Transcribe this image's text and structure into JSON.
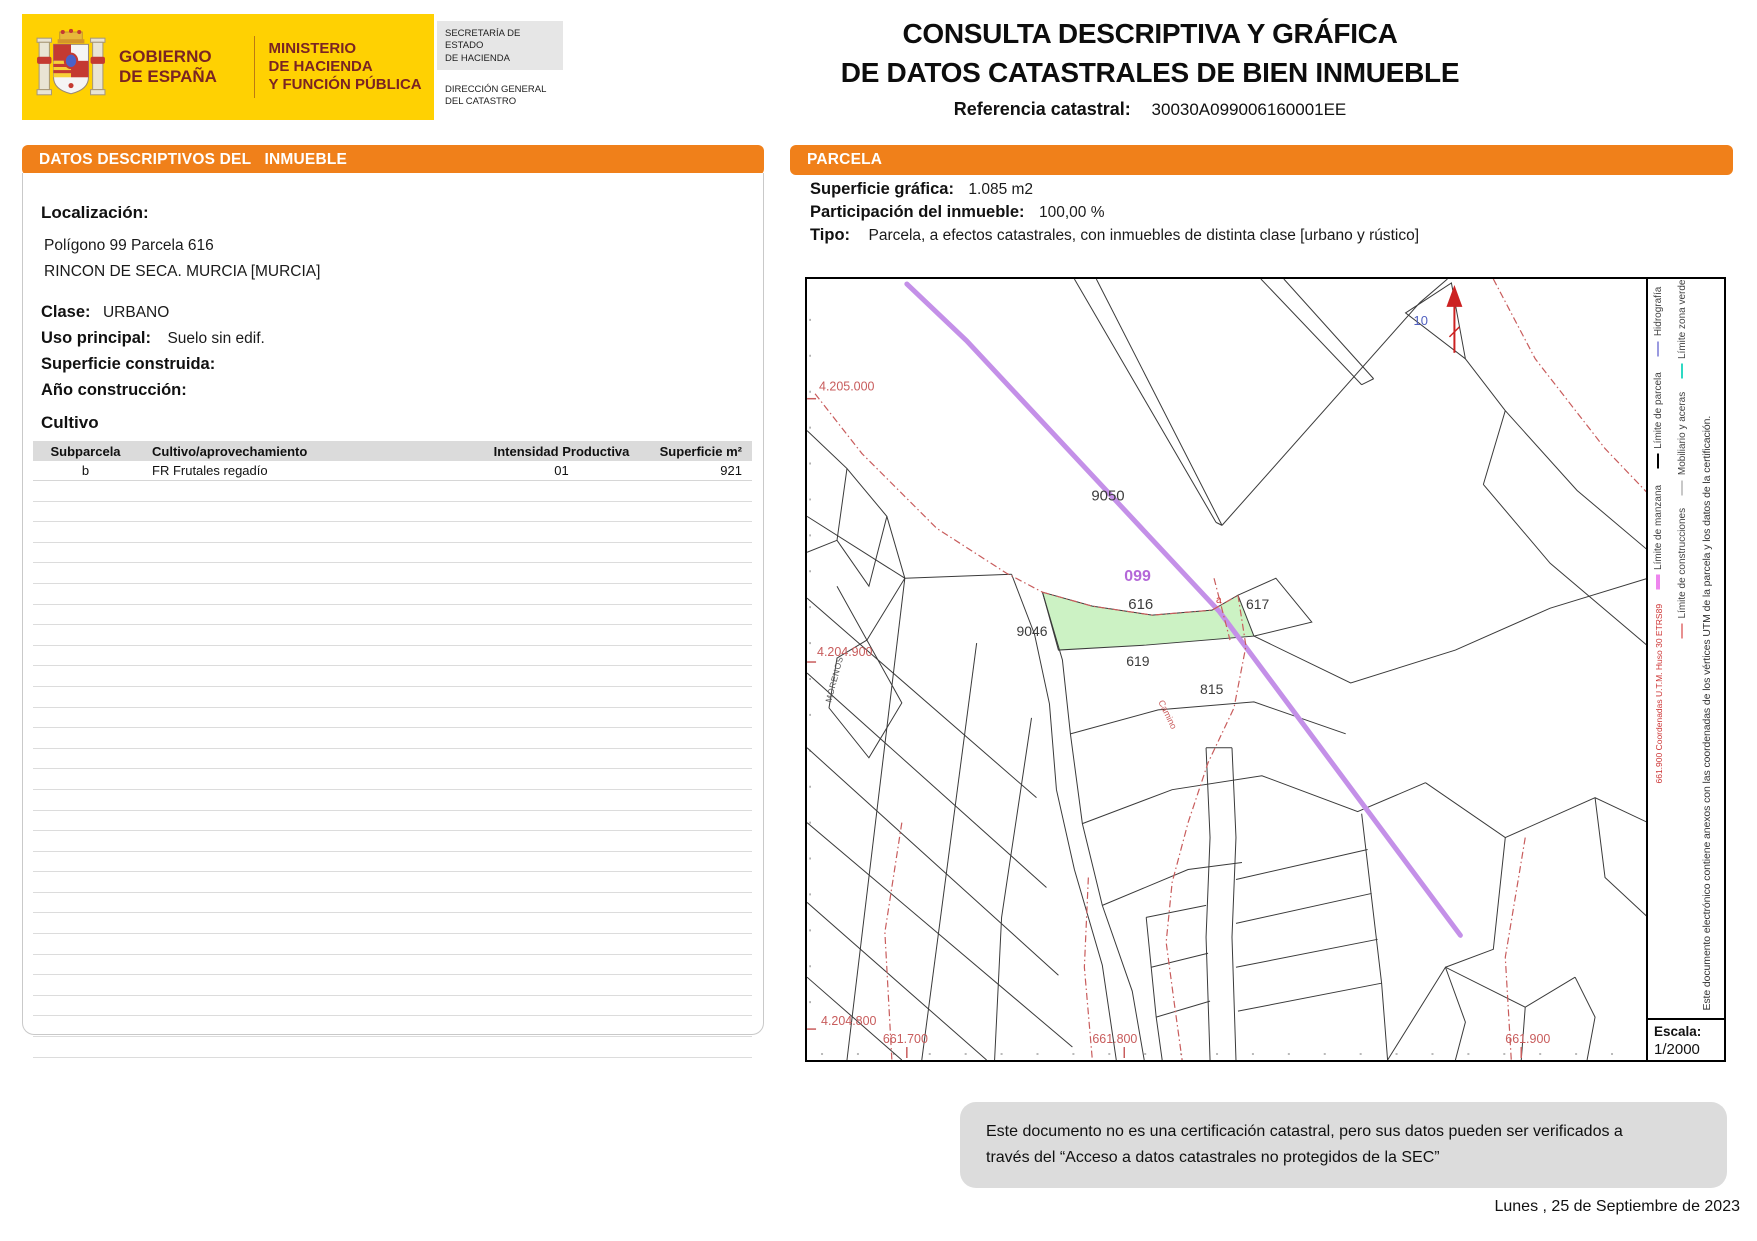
{
  "header": {
    "logo": {
      "gobierno_line1": "GOBIERNO",
      "gobierno_line2": "DE ESPAÑA",
      "ministerio_line1": "MINISTERIO",
      "ministerio_line2": "DE HACIENDA",
      "ministerio_line3": "Y FUNCIÓN PÚBLICA"
    },
    "secretaria_line1": "SECRETARÍA DE ESTADO",
    "secretaria_line2": "DE HACIENDA",
    "direccion_line1": "DIRECCIÓN GENERAL",
    "direccion_line2": "DEL CATASTRO",
    "title_line1": "CONSULTA DESCRIPTIVA Y GRÁFICA",
    "title_line2": "DE DATOS CATASTRALES DE BIEN INMUEBLE",
    "referencia_label": "Referencia catastral:",
    "referencia_value": "30030A099006160001EE"
  },
  "colors": {
    "accent_orange": "#F0801A",
    "gov_yellow": "#FFD102",
    "gov_maroon": "#7A2423",
    "parcel_green": "#CCF2C4",
    "hydro_purple": "#C490E8",
    "red_boundary": "#C85C5C"
  },
  "left_panel": {
    "title_prefix": "DATOS DESCRIPTIVOS DEL",
    "title_bold": "INMUEBLE",
    "localizacion_label": "Localización:",
    "localizacion_line1": "Polígono 99 Parcela 616",
    "localizacion_line2": "RINCON DE SECA. MURCIA [MURCIA]",
    "clase_label": "Clase:",
    "clase_value": "URBANO",
    "uso_label": "Uso principal:",
    "uso_value": "Suelo sin edif.",
    "superficie_label": "Superficie construida:",
    "ano_label": "Año construcción:",
    "cultivo_heading": "Cultivo",
    "table": {
      "headers": [
        "Subparcela",
        "Cultivo/aprovechamiento",
        "Intensidad Productiva",
        "Superficie m²"
      ],
      "rows": [
        {
          "subparcela": "b",
          "cultivo": "FR Frutales regadío",
          "intensidad": "01",
          "superficie": "921"
        }
      ]
    }
  },
  "right_panel": {
    "title": "PARCELA",
    "superficie_label": "Superficie gráfica:",
    "superficie_value": "1.085 m2",
    "participacion_label": "Participación del inmueble:",
    "participacion_value": "100,00 %",
    "tipo_label": "Tipo:",
    "tipo_value": "Parcela, a efectos catastrales, con inmuebles de distinta clase [urbano y rústico]",
    "map": {
      "labels": {
        "zona": "9050",
        "poligono": "099",
        "parcela": "616",
        "subparcela_a": "a",
        "parcela_617": "617",
        "parcela_619": "619",
        "parcela_815": "815",
        "parcela_9046": "9046",
        "esquina": "10",
        "calle_morenos": "MORENOS",
        "camino": "Camino"
      },
      "coords": {
        "y_4205000": "4.205.000",
        "y_4204900": "4.204.900",
        "y_4204800": "4.204.800",
        "x_661700": "661.700",
        "x_661800": "661.800",
        "x_661900": "661.900"
      }
    },
    "legend": {
      "entries": [
        {
          "label": "Límite de parcela",
          "color": "#000000"
        },
        {
          "label": "Hidrografía",
          "color": "#9A9AE0"
        },
        {
          "label": "Mobiliario y aceras",
          "color": "#C8C8C8"
        },
        {
          "label": "Límite zona verde",
          "color": "#2ED9C3"
        },
        {
          "label": "Límite de manzana",
          "color": "#EE85EE"
        },
        {
          "label": "Límite de construcciones",
          "color": "#E89090"
        }
      ],
      "coords_note": "661.900 Coordenadas U.T.M. Huso 30 ETRS89",
      "cert_note": "Este documento electrónico contiene anexos con las coordenadas de los vértices UTM de la parcela y los datos de la certificación."
    },
    "escala_label": "Escala:",
    "escala_value": "1/2000"
  },
  "footer": {
    "disclaimer_line1": "Este documento no es una certificación catastral, pero sus datos pueden ser verificados a",
    "disclaimer_line2": "través del “Acceso a datos catastrales no protegidos de la SEC”",
    "date": "Lunes , 25 de Septiembre de 2023"
  }
}
